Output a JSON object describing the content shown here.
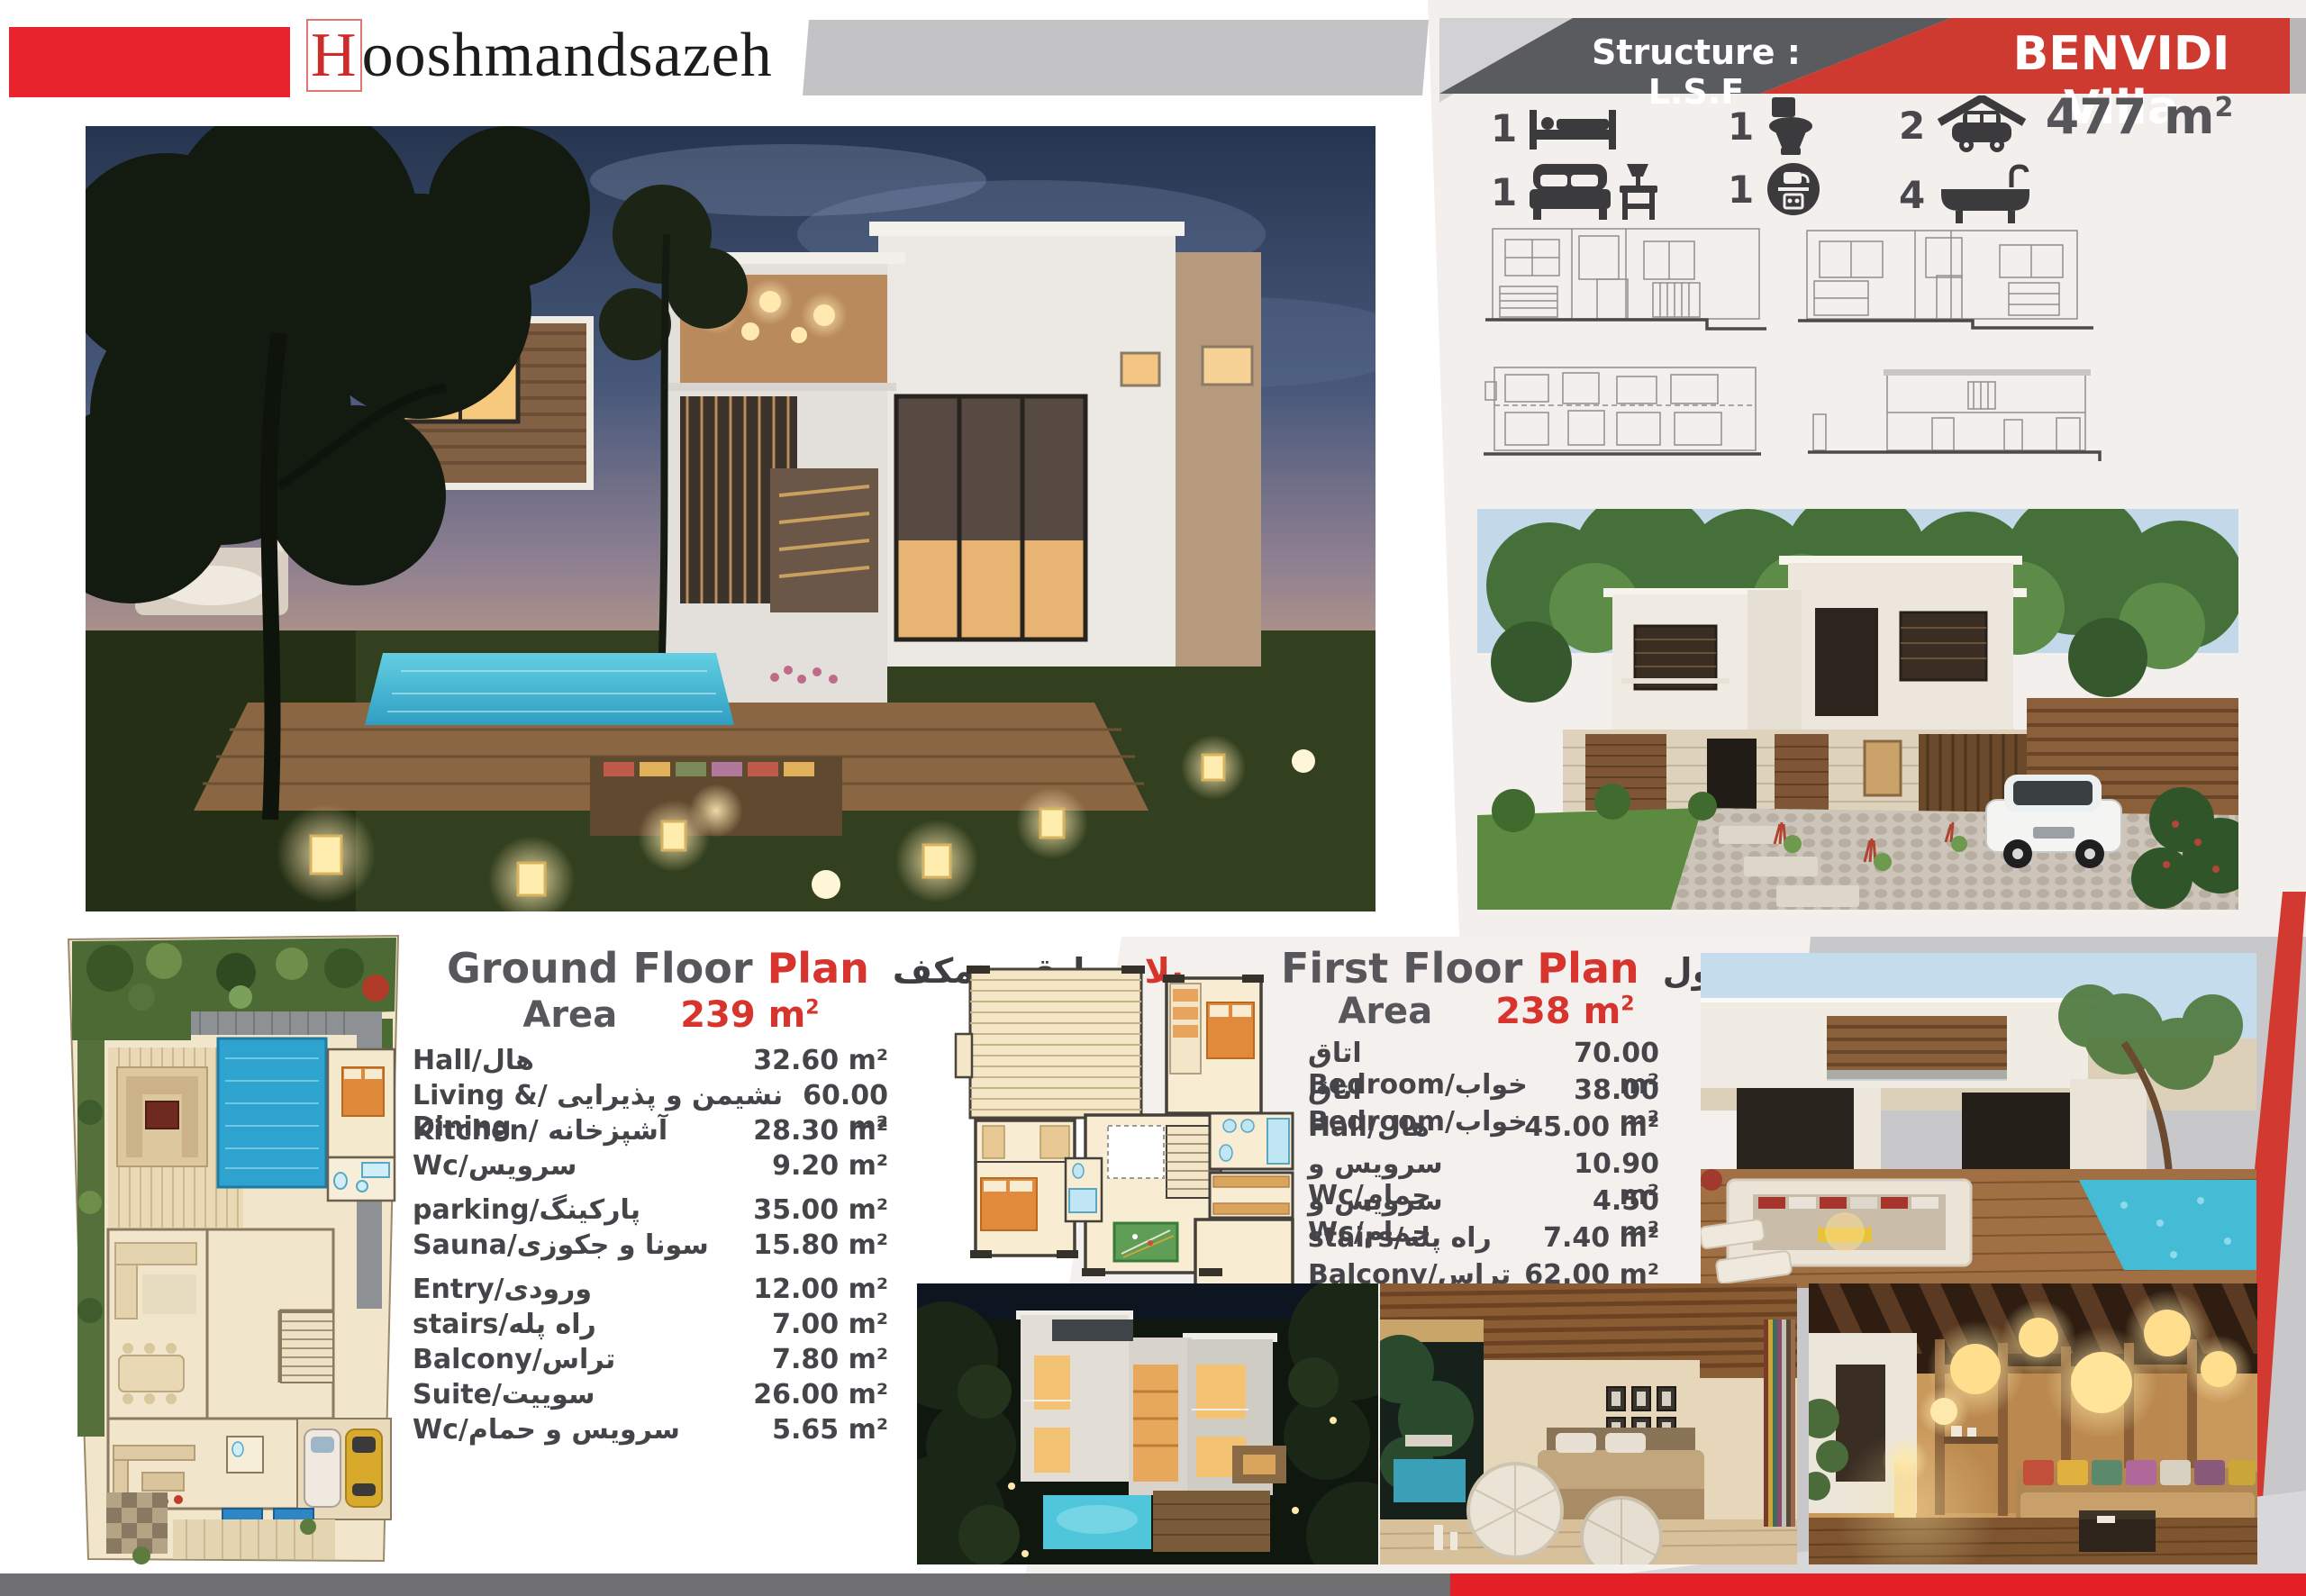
{
  "brand": {
    "logo_initial": "H",
    "logo_rest": "ooshmandsazeh"
  },
  "header": {
    "structure": "Structure : L.S.F",
    "villa": "BENVIDI Villa",
    "area_value": "477 m",
    "area_sup": "2",
    "accent_red": "#cf3a30",
    "accent_dark": "#595b5f"
  },
  "features": {
    "single_beds": "1",
    "toilets": "1",
    "garage_cars": "2",
    "double_beds": "1",
    "kitchens": "1",
    "bathtubs": "4"
  },
  "ground_floor": {
    "title_en": "Ground Floor",
    "title_en_red": "Plan",
    "title_fa_red": "پلان",
    "title_fa_rest": "طبقه همکف",
    "area_label": "Area",
    "area_value": "239 m",
    "area_sup": "2",
    "rows": [
      {
        "label": "هال/Hall",
        "value": "32.60 m²"
      },
      {
        "label": "نشیمن و پذیرایی /Living & Dining",
        "value": "60.00 m²"
      },
      {
        "label": "آشپزخانه /Kitchen",
        "value": "28.30 m²"
      },
      {
        "label": "سرویس/Wc",
        "value": "9.20 m²"
      },
      {
        "label": "پارکینگ/parking",
        "value": "35.00 m²"
      },
      {
        "label": "سونا و جکوزی/Sauna",
        "value": "15.80 m²"
      },
      {
        "label": "ورودی/Entry",
        "value": "12.00 m²"
      },
      {
        "label": "راه پله/stairs",
        "value": "7.00 m²"
      },
      {
        "label": "تراس/Balcony",
        "value": "7.80 m²"
      },
      {
        "label": "سوییت/Suite",
        "value": "26.00 m²"
      },
      {
        "label": "سرویس و حمام/Wc",
        "value": "5.65 m²"
      }
    ]
  },
  "first_floor": {
    "title_en": "First Floor",
    "title_en_red": "Plan",
    "title_fa_red": "پلان",
    "title_fa_rest": "طبقه اول",
    "area_label": "Area",
    "area_value": "238 m",
    "area_sup": "2",
    "rows": [
      {
        "label": "اتاق خواب/Bedroom",
        "value": "70.00 m²"
      },
      {
        "label": "اتاق خواب/Bedroom",
        "value": "38.00 m²"
      },
      {
        "label": "هال/Hall",
        "value": "45.00 m²"
      },
      {
        "label": "سرویس و حمام/Wc",
        "value": "10.90 m²"
      },
      {
        "label": "سرویس و حمام/Wc",
        "value": "4.50 m²"
      },
      {
        "label": "راه پله/stairs",
        "value": "7.40 m²"
      },
      {
        "label": "تراس/Balcony",
        "value": "62.00 m²"
      }
    ]
  }
}
